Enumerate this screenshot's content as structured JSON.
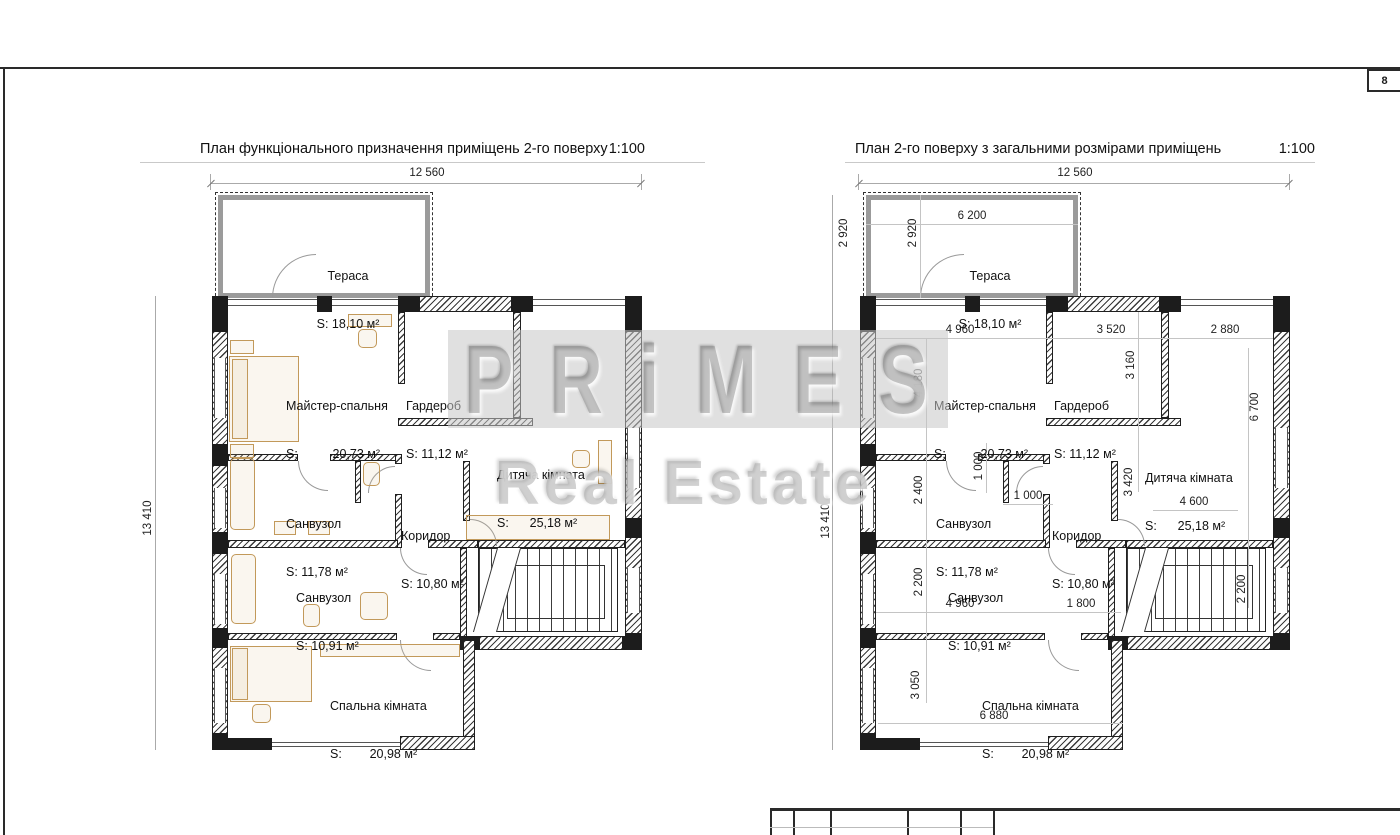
{
  "sheet": {
    "number": "8"
  },
  "watermark": {
    "line1": "PRiMES",
    "line2": "Real Estate"
  },
  "left_plan": {
    "title": "План функціонального призначення приміщень 2-го поверху",
    "scale": "1:100",
    "dim_width": "12 560",
    "dim_height": "13 410",
    "rooms": {
      "terrace": {
        "name": "Тераса",
        "area": "S: 18,10 м²"
      },
      "master": {
        "name": "Майстер-спальня",
        "area": "S:          20,73 м²"
      },
      "wardrobe": {
        "name": "Гардероб",
        "area": "S: 11,12 м²"
      },
      "children": {
        "name": "Дитяча кімната",
        "area": "S:      25,18 м²"
      },
      "bath1": {
        "name": "Санвузол",
        "area": "S: 11,78 м²"
      },
      "corridor": {
        "name": "Коридор",
        "area": "S: 10,80 м²"
      },
      "bath2": {
        "name": "Санвузол",
        "area": "S: 10,91 м²"
      },
      "bedroom": {
        "name": "Спальна кімната",
        "area": "S:        20,98 м²"
      }
    }
  },
  "right_plan": {
    "title": "План 2-го поверху з загальними розмірами приміщень",
    "scale": "1:100",
    "dim_width": "12 560",
    "dim_height": "13 410",
    "rooms": {
      "terrace": {
        "name": "Тераса",
        "area": "S: 18,10 м²"
      },
      "master": {
        "name": "Майстер-спальня",
        "area": "S:          20,73 м²"
      },
      "wardrobe": {
        "name": "Гардероб",
        "area": "S: 11,12 м²"
      },
      "children": {
        "name": "Дитяча кімната",
        "area": "S:      25,18 м²"
      },
      "bath1": {
        "name": "Санвузол",
        "area": "S: 11,78 м²"
      },
      "corridor": {
        "name": "Коридор",
        "area": "S: 10,80 м²"
      },
      "bath2": {
        "name": "Санвузол",
        "area": "S: 10,91 м²"
      },
      "bedroom": {
        "name": "Спальна кімната",
        "area": "S:        20,98 м²"
      }
    },
    "dims": {
      "terrace_width": "6 200",
      "terrace_height_outer": "2 920",
      "terrace_height_inner": "2 920",
      "row1_a": "4 960",
      "row1_b": "3 520",
      "row1_c": "2 880",
      "master_height": "4 180",
      "wardrobe_height": "3 160",
      "children_height": "6 700",
      "niche_v": "1 000",
      "niche_h": "1 000",
      "bath1_height": "2 400",
      "children_inner_height": "3 420",
      "children_width": "4 600",
      "bath2_height": "2 200",
      "bath2_width": "4 960",
      "corridor_width": "1 800",
      "stairs_height": "2 200",
      "bedroom_height": "3 050",
      "bedroom_width": "6 880"
    }
  }
}
